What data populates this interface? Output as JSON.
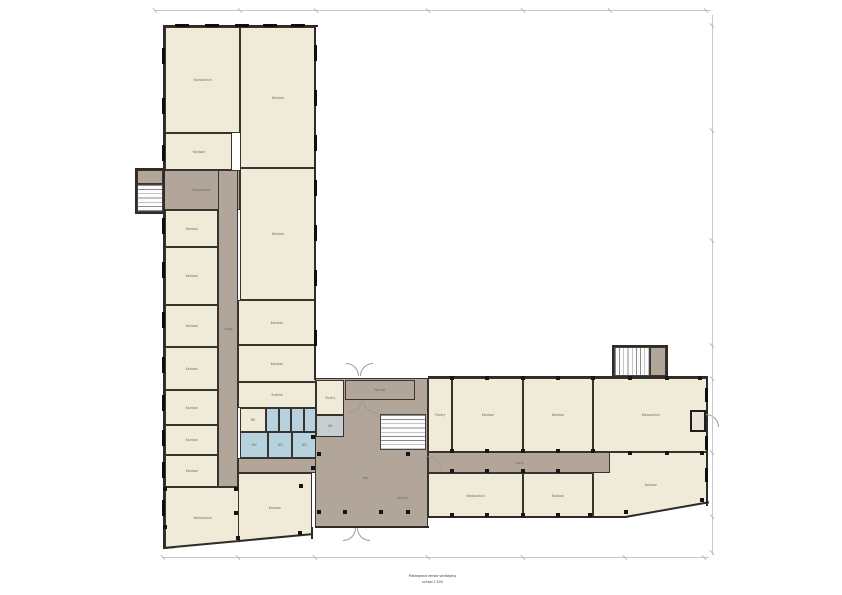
{
  "canvas": {
    "w": 842,
    "h": 595
  },
  "colors": {
    "room_fill": "#f0ead9",
    "corridor_fill": "#b1a699",
    "wet_fill": "#b6d2de",
    "lift_fill": "#c6ced2",
    "wall": "#2f2b26",
    "window": "#0e0e0e",
    "dim_line": "#c7c7c7"
  },
  "caption": {
    "line1": "Plattegrond eerste verdieping",
    "line2": "schaal 1:200"
  },
  "plan": {
    "rooms": [
      {
        "n": "room-kantoortuin-nw",
        "l": "Kantoortuin",
        "b": [
          165,
          27,
          75,
          106
        ]
      },
      {
        "n": "room-kantoor-ne-1",
        "l": "Kantoor",
        "b": [
          240,
          27,
          76,
          141
        ]
      },
      {
        "n": "room-kantoor-w1",
        "l": "Kantoor",
        "b": [
          165,
          133,
          67,
          37
        ]
      },
      {
        "n": "corridor-west-hall",
        "l": "Trappenhuis",
        "b": [
          163,
          170,
          77,
          40
        ],
        "t": "corridor"
      },
      {
        "n": "stair-west-landing",
        "b": [
          137,
          170,
          26,
          14
        ],
        "t": "corridor"
      },
      {
        "n": "stair-west",
        "b": [
          137,
          184,
          26,
          28
        ],
        "t": "stair-h"
      },
      {
        "n": "room-kantoor-w2",
        "l": "Kantoor",
        "b": [
          165,
          210,
          53,
          37
        ]
      },
      {
        "n": "room-kantoor-w3",
        "l": "Kantoor",
        "b": [
          165,
          247,
          53,
          58
        ]
      },
      {
        "n": "room-kantoor-ne-2",
        "l": "Kantoor",
        "b": [
          240,
          168,
          76,
          132
        ]
      },
      {
        "n": "room-kantoor-w4",
        "l": "Kantoor",
        "b": [
          165,
          305,
          53,
          42
        ]
      },
      {
        "n": "room-kantoor-w5",
        "l": "Kantoor",
        "b": [
          165,
          347,
          53,
          43
        ]
      },
      {
        "n": "room-kantoor-w6",
        "l": "Kantoor",
        "b": [
          165,
          390,
          53,
          35
        ]
      },
      {
        "n": "room-kantoor-w7",
        "l": "Kantoor",
        "b": [
          165,
          425,
          53,
          30
        ]
      },
      {
        "n": "room-kantoor-w8",
        "l": "Kantoor",
        "b": [
          165,
          455,
          53,
          32
        ]
      },
      {
        "n": "corridor-main-west",
        "l": "Gang",
        "b": [
          218,
          170,
          20,
          317
        ],
        "t": "corridor"
      },
      {
        "n": "room-kantoor-e1",
        "l": "Kantoor",
        "b": [
          238,
          300,
          78,
          45
        ]
      },
      {
        "n": "room-kantoor-e2",
        "l": "Kantoor",
        "b": [
          238,
          345,
          78,
          37
        ]
      },
      {
        "n": "room-ruimte",
        "l": "Ruimte",
        "b": [
          238,
          382,
          78,
          26
        ]
      },
      {
        "n": "room-werkkast",
        "l": "MK",
        "b": [
          240,
          408,
          26,
          24
        ]
      },
      {
        "n": "wc-stall-1",
        "b": [
          266,
          408,
          12.5,
          24
        ],
        "t": "wet"
      },
      {
        "n": "wc-stall-2",
        "b": [
          278.5,
          408,
          12.5,
          24
        ],
        "t": "wet"
      },
      {
        "n": "wc-stall-3",
        "b": [
          291,
          408,
          12.5,
          24
        ],
        "t": "wet"
      },
      {
        "n": "wc-stall-4",
        "b": [
          303.5,
          408,
          12.5,
          24
        ],
        "t": "wet"
      },
      {
        "n": "wc-room-1",
        "l": "WC",
        "b": [
          240,
          432,
          28,
          26
        ],
        "t": "wet"
      },
      {
        "n": "wc-room-2",
        "l": "WC",
        "b": [
          268,
          432,
          24,
          26
        ],
        "t": "wet"
      },
      {
        "n": "wc-room-3",
        "l": "WC",
        "b": [
          292,
          432,
          24,
          26
        ],
        "t": "wet"
      },
      {
        "n": "corridor-toilet",
        "b": [
          238,
          458,
          78,
          15
        ],
        "t": "corridor"
      },
      {
        "n": "room-kantoortuin-sw",
        "l": "Kantoortuin",
        "b": [
          165,
          487,
          75,
          62
        ],
        "clip": "polygon(0 0,100% 0,100% 89%,0 100%)"
      },
      {
        "n": "room-kantoor-s",
        "l": "Kantoor",
        "b": [
          238,
          473,
          74,
          69
        ],
        "clip": "polygon(0 0,100% 0,100% 90%,0 100%)"
      },
      {
        "n": "hall-main",
        "b": [
          315,
          378,
          113,
          149
        ],
        "t": "corridor"
      },
      {
        "n": "room-pantry-hall",
        "l": "Pantry",
        "b": [
          316,
          380,
          28,
          35
        ]
      },
      {
        "n": "lift",
        "l": "Lift",
        "b": [
          316,
          415,
          28,
          22
        ],
        "t": "gray"
      },
      {
        "n": "vestibule-north",
        "l": "Portaal",
        "b": [
          345,
          380,
          70,
          20
        ],
        "t": "corridor"
      },
      {
        "n": "stair-main",
        "b": [
          380,
          414,
          46,
          36
        ],
        "t": "stair-h"
      },
      {
        "n": "room-pantry-r1",
        "l": "Pantry",
        "b": [
          428,
          378,
          24,
          74
        ]
      },
      {
        "n": "room-kantoor-r2",
        "l": "Kantoor",
        "b": [
          452,
          378,
          71,
          74
        ]
      },
      {
        "n": "room-kantoor-r3",
        "l": "Kantoor",
        "b": [
          523,
          378,
          70,
          74
        ]
      },
      {
        "n": "room-kantoortuin-r4",
        "l": "Kantoortuin",
        "b": [
          593,
          378,
          115,
          74
        ]
      },
      {
        "n": "corridor-east",
        "l": "Gang",
        "b": [
          428,
          452,
          182,
          21
        ],
        "t": "corridor"
      },
      {
        "n": "room-kantoortuin-rb1",
        "l": "Kantoortuin",
        "b": [
          428,
          473,
          95,
          45
        ]
      },
      {
        "n": "room-kantoor-rb2",
        "l": "Kantoor",
        "b": [
          523,
          473,
          70,
          45
        ]
      },
      {
        "n": "room-kantoor-rb3",
        "l": "Kantoor",
        "b": [
          593,
          452,
          115,
          66
        ],
        "clip": "polygon(14.8% 0,100% 0,100% 77%,27.8% 100%,0 100%,0 32%,14.8% 32%)"
      },
      {
        "n": "stair-ne-landing",
        "b": [
          650,
          347,
          16,
          29
        ],
        "t": "corridor"
      },
      {
        "n": "stair-ne",
        "b": [
          614,
          347,
          36,
          29
        ],
        "t": "stair-v"
      },
      {
        "n": "entry-east",
        "b": [
          690,
          410,
          16,
          22
        ],
        "t": "entry"
      }
    ],
    "walls": [
      [
        163,
        25,
        155,
        2
      ],
      [
        163,
        25,
        2,
        524
      ],
      [
        314,
        25,
        2,
        355
      ],
      [
        135,
        168,
        30,
        2
      ],
      [
        135,
        168,
        2,
        46
      ],
      [
        135,
        212,
        28,
        2
      ],
      [
        315,
        526,
        114,
        2
      ],
      [
        311,
        527,
        2,
        12
      ],
      [
        428,
        376,
        280,
        2
      ],
      [
        706,
        376,
        2,
        130
      ],
      [
        428,
        516,
        167,
        2
      ],
      [
        593,
        516,
        34,
        2
      ],
      [
        612,
        345,
        56,
        2
      ],
      [
        612,
        345,
        2,
        33
      ],
      [
        666,
        345,
        2,
        33
      ]
    ],
    "slants": [
      [
        163,
        547,
        150,
        -5.3
      ],
      [
        625,
        516,
        85,
        -10
      ]
    ],
    "windows": [
      [
        161.5,
        48,
        3.5,
        16
      ],
      [
        161.5,
        98,
        3.5,
        16
      ],
      [
        161.5,
        145,
        3.5,
        16
      ],
      [
        161.5,
        218,
        3.5,
        16
      ],
      [
        161.5,
        262,
        3.5,
        16
      ],
      [
        161.5,
        312,
        3.5,
        16
      ],
      [
        161.5,
        357,
        3.5,
        16
      ],
      [
        161.5,
        395,
        3.5,
        16
      ],
      [
        161.5,
        430,
        3.5,
        16
      ],
      [
        161.5,
        462,
        3.5,
        16
      ],
      [
        161.5,
        500,
        3.5,
        16
      ],
      [
        175,
        23.5,
        14,
        3.5
      ],
      [
        205,
        23.5,
        14,
        3.5
      ],
      [
        235,
        23.5,
        14,
        3.5
      ],
      [
        263,
        23.5,
        14,
        3.5
      ],
      [
        291,
        23.5,
        14,
        3.5
      ],
      [
        313.5,
        45,
        3.5,
        16
      ],
      [
        313.5,
        90,
        3.5,
        16
      ],
      [
        313.5,
        135,
        3.5,
        16
      ],
      [
        313.5,
        180,
        3.5,
        16
      ],
      [
        313.5,
        225,
        3.5,
        16
      ],
      [
        313.5,
        270,
        3.5,
        16
      ],
      [
        313.5,
        330,
        3.5,
        16
      ],
      [
        704.5,
        388,
        3.5,
        14
      ],
      [
        704.5,
        436,
        3.5,
        14
      ],
      [
        704.5,
        468,
        3.5,
        14
      ]
    ],
    "columns": [
      [
        452,
        378
      ],
      [
        487,
        378
      ],
      [
        523,
        378
      ],
      [
        558,
        378
      ],
      [
        593,
        378
      ],
      [
        630,
        378
      ],
      [
        667,
        378
      ],
      [
        700,
        378
      ],
      [
        452,
        451
      ],
      [
        487,
        451
      ],
      [
        523,
        451
      ],
      [
        558,
        451
      ],
      [
        593,
        451
      ],
      [
        630,
        453
      ],
      [
        667,
        453
      ],
      [
        452,
        471
      ],
      [
        487,
        471
      ],
      [
        523,
        471
      ],
      [
        558,
        471
      ],
      [
        452,
        515
      ],
      [
        487,
        515
      ],
      [
        523,
        515
      ],
      [
        558,
        515
      ],
      [
        590,
        515
      ],
      [
        626,
        512
      ],
      [
        702,
        500
      ],
      [
        702,
        453
      ],
      [
        319,
        454
      ],
      [
        408,
        454
      ],
      [
        345,
        512
      ],
      [
        381,
        512
      ],
      [
        319,
        512
      ],
      [
        408,
        512
      ],
      [
        165,
        489
      ],
      [
        165,
        527
      ],
      [
        236,
        489
      ],
      [
        236,
        513
      ],
      [
        301,
        486
      ],
      [
        238,
        538
      ],
      [
        300,
        533
      ],
      [
        313,
        437
      ],
      [
        313,
        468
      ]
    ],
    "arcs": [
      [
        346,
        363,
        "tr"
      ],
      [
        360,
        363,
        "tl"
      ],
      [
        349,
        400,
        "br"
      ],
      [
        363,
        400,
        "bl"
      ],
      [
        343,
        528,
        "br"
      ],
      [
        357,
        528,
        "bl"
      ],
      [
        706,
        414,
        "tr"
      ],
      [
        428,
        456,
        "tr"
      ]
    ],
    "labels": [
      [
        "Hal",
        362,
        476
      ],
      [
        "Entree",
        396,
        496
      ]
    ],
    "dims": {
      "lines": [
        [
          155,
          10,
          556,
          1
        ],
        [
          712,
          15,
          1,
          540
        ],
        [
          163,
          557,
          546,
          1
        ]
      ],
      "ticks": [
        [
          155,
          10
        ],
        [
          240,
          10
        ],
        [
          316,
          10
        ],
        [
          428,
          10
        ],
        [
          523,
          10
        ],
        [
          610,
          10
        ],
        [
          706,
          10
        ],
        [
          712,
          25
        ],
        [
          712,
          130
        ],
        [
          712,
          240
        ],
        [
          712,
          345
        ],
        [
          712,
          378
        ],
        [
          712,
          452
        ],
        [
          712,
          516
        ],
        [
          712,
          552
        ],
        [
          163,
          557
        ],
        [
          238,
          557
        ],
        [
          315,
          557
        ],
        [
          428,
          557
        ],
        [
          523,
          557
        ],
        [
          625,
          557
        ],
        [
          704,
          557
        ]
      ]
    }
  }
}
